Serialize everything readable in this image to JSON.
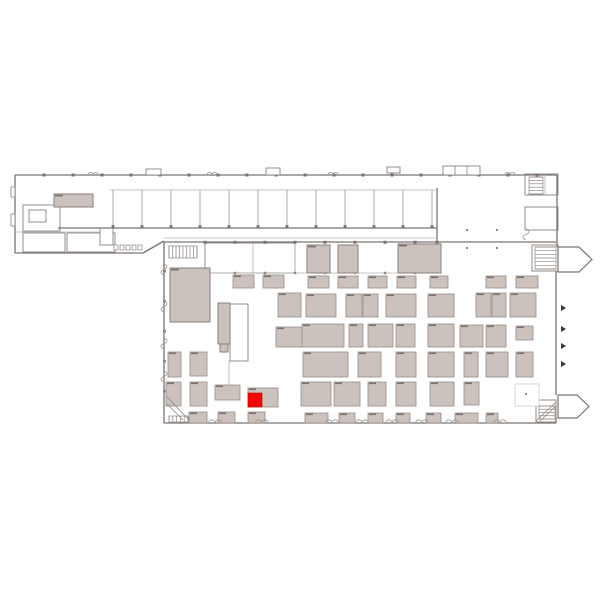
{
  "meta": {
    "view": "exhibition-hall-floor-plan",
    "highlight_count": 1
  },
  "colors": {
    "background": "#ffffff",
    "wall": "#7a7370",
    "light_wall": "#b7b0ac",
    "booth_fill": "#cbc2be",
    "booth_stroke": "#968b86",
    "booth_label": "#7d6f6a",
    "room_stroke": "#8a827e",
    "gray_room_stroke": "#8a7f7a",
    "highlight": "#fb0400",
    "marker": "#3a3633",
    "faint": "#d8d3d0"
  },
  "map": {
    "walls": [
      [
        15,
        175,
        557,
        175
      ],
      [
        15,
        175,
        15,
        253
      ],
      [
        15,
        253,
        143,
        253
      ],
      [
        143,
        253,
        164,
        241
      ],
      [
        58,
        228,
        437,
        228
      ],
      [
        437,
        188,
        437,
        241
      ],
      [
        557,
        175,
        557,
        247
      ],
      [
        556,
        271,
        556,
        395
      ],
      [
        556,
        418,
        556,
        423
      ],
      [
        164,
        242,
        556,
        242
      ],
      [
        164,
        242,
        164,
        423
      ],
      [
        164,
        423,
        556,
        423
      ]
    ],
    "light_walls": [
      [
        110,
        190,
        437,
        190
      ],
      [
        15,
        232,
        100,
        232
      ],
      [
        205,
        273,
        441,
        273
      ],
      [
        253,
        243,
        253,
        273
      ],
      [
        295,
        243,
        295,
        273
      ],
      [
        229,
        361,
        229,
        388
      ],
      [
        164,
        238,
        437,
        238
      ],
      [
        545,
        174,
        545,
        195
      ],
      [
        218,
        323,
        230,
        323
      ],
      [
        218,
        333,
        230,
        333
      ],
      [
        441,
        295,
        441,
        316
      ],
      [
        519,
        293,
        519,
        317
      ],
      [
        406,
        353,
        406,
        376
      ],
      [
        316,
        383,
        316,
        405
      ],
      [
        347,
        383,
        347,
        405
      ],
      [
        406,
        383,
        406,
        405
      ],
      [
        442,
        383,
        442,
        405
      ],
      [
        362,
        325,
        362,
        346
      ]
    ],
    "partitions": {
      "xs": [
        113,
        142,
        171,
        200,
        229,
        258,
        287,
        316,
        345,
        374,
        403,
        432
      ],
      "y1": 190,
      "y2": 227.5
    },
    "top_ticks": {
      "xs": [
        44,
        73,
        102,
        131,
        160,
        189,
        218,
        247,
        276,
        305,
        334,
        363,
        392,
        421,
        450,
        479,
        508,
        537
      ],
      "y": 173.5
    },
    "hall_ticks": {
      "xs": [
        205,
        235,
        265,
        295,
        325,
        355,
        385,
        415,
        437
      ],
      "y": 240.8
    },
    "band_ticks": {
      "xs": [
        235,
        265,
        295,
        325,
        355,
        385,
        415
      ],
      "y": 271.8
    },
    "left_ticks": {
      "ys": [
        270,
        300,
        330,
        360,
        390
      ],
      "x": 163
    },
    "gray_rooms": [
      [
        54,
        194,
        39,
        13
      ],
      [
        170,
        268,
        40,
        54
      ],
      [
        307,
        245,
        23,
        28
      ],
      [
        338,
        245,
        20,
        28
      ],
      [
        398,
        244,
        43,
        29
      ],
      [
        218,
        303,
        12,
        41
      ],
      [
        220,
        344,
        8,
        8
      ]
    ],
    "white_rooms": [
      [
        23,
        205,
        37,
        26
      ],
      [
        23,
        233,
        42,
        19
      ],
      [
        67,
        233,
        48,
        19
      ],
      [
        100,
        228,
        13,
        17
      ],
      [
        525,
        174,
        33,
        21
      ],
      [
        525,
        207,
        33,
        23
      ],
      [
        532,
        245,
        26,
        26
      ],
      [
        230,
        304,
        18,
        57
      ],
      [
        536,
        400,
        20,
        22
      ],
      [
        205,
        243,
        90,
        30
      ]
    ],
    "light_rooms": [
      [
        515,
        384,
        24,
        22
      ]
    ],
    "booths": [
      [
        233,
        275,
        21,
        13
      ],
      [
        263,
        275,
        21,
        13
      ],
      [
        308,
        276,
        21,
        12
      ],
      [
        338,
        276,
        20,
        12
      ],
      [
        368,
        276,
        19,
        12
      ],
      [
        397,
        276,
        19,
        12
      ],
      [
        430,
        276,
        18,
        12
      ],
      [
        486,
        276,
        20,
        12
      ],
      [
        516,
        276,
        22,
        12
      ],
      [
        278,
        293,
        23,
        24
      ],
      [
        306,
        294,
        30,
        23
      ],
      [
        346,
        294,
        16,
        23
      ],
      [
        363,
        294,
        15,
        23
      ],
      [
        386,
        294,
        30,
        23
      ],
      [
        428,
        294,
        26,
        23
      ],
      [
        476,
        293,
        15,
        24
      ],
      [
        492,
        293,
        14,
        24
      ],
      [
        510,
        293,
        26,
        24
      ],
      [
        276,
        327,
        27,
        20
      ],
      [
        302,
        324,
        42,
        23
      ],
      [
        349,
        324,
        14,
        23
      ],
      [
        368,
        324,
        25,
        23
      ],
      [
        396,
        324,
        19,
        23
      ],
      [
        428,
        324,
        26,
        23
      ],
      [
        460,
        325,
        23,
        22
      ],
      [
        486,
        325,
        20,
        22
      ],
      [
        516,
        326,
        17,
        14
      ],
      [
        168,
        352,
        13,
        25
      ],
      [
        190,
        352,
        17,
        24
      ],
      [
        303,
        352,
        45,
        25
      ],
      [
        358,
        352,
        23,
        25
      ],
      [
        396,
        352,
        20,
        25
      ],
      [
        428,
        352,
        26,
        25
      ],
      [
        464,
        352,
        14,
        25
      ],
      [
        486,
        352,
        22,
        25
      ],
      [
        516,
        352,
        17,
        25
      ],
      [
        166,
        382,
        15,
        24
      ],
      [
        190,
        382,
        17,
        24
      ],
      [
        215,
        385,
        25,
        15
      ],
      [
        248,
        388,
        30,
        19
      ],
      [
        301,
        382,
        30,
        24
      ],
      [
        334,
        382,
        26,
        24
      ],
      [
        368,
        382,
        18,
        24
      ],
      [
        396,
        382,
        20,
        24
      ],
      [
        430,
        382,
        24,
        24
      ],
      [
        464,
        382,
        15,
        23
      ],
      [
        189,
        412,
        18,
        11
      ],
      [
        218,
        412,
        17,
        11
      ],
      [
        248,
        412,
        17,
        11
      ],
      [
        305,
        413,
        23,
        10
      ],
      [
        339,
        413,
        16,
        10
      ],
      [
        368,
        413,
        15,
        10
      ],
      [
        396,
        413,
        14,
        10
      ],
      [
        426,
        413,
        15,
        10
      ],
      [
        455,
        413,
        23,
        10
      ],
      [
        486,
        413,
        12,
        10
      ]
    ],
    "highlight_booth": [
      248,
      393,
      14,
      14
    ],
    "stairs": [
      {
        "x": 169,
        "y": 246,
        "w": 28,
        "h": 12,
        "n": 9,
        "dir": "v"
      },
      {
        "x": 529,
        "y": 177,
        "w": 14,
        "h": 17,
        "n": 6,
        "dir": "h"
      },
      {
        "x": 535,
        "y": 247,
        "w": 21,
        "h": 22,
        "n": 7,
        "dir": "h"
      },
      {
        "x": 559,
        "y": 400,
        "w": 13,
        "h": 17,
        "n": 6,
        "dir": "h"
      },
      {
        "x": 539,
        "y": 406,
        "w": 16,
        "h": 13,
        "n": 5,
        "dir": "h"
      },
      {
        "x": 169,
        "y": 416,
        "w": 19,
        "h": 6,
        "n": 6,
        "dir": "v"
      },
      {
        "x": 30,
        "y": 212,
        "w": 15,
        "h": 8,
        "n": 3,
        "dir": "h"
      }
    ],
    "arrows": [
      "558,247 579,247 592,259.5 579,272 558,272",
      "558,395 577,395 589,406.5 577,418 558,418"
    ],
    "markers": [
      [
        561,
        305
      ],
      [
        561,
        326
      ],
      [
        561,
        343
      ],
      [
        561,
        361
      ]
    ],
    "top_boxes": [
      [
        146,
        169,
        15,
        6
      ],
      [
        266,
        168,
        14,
        7
      ],
      [
        387,
        167,
        13,
        6
      ],
      [
        443,
        166,
        37,
        9
      ]
    ],
    "box_dividers": [
      [
        455,
        166,
        455,
        175
      ],
      [
        467,
        166,
        467,
        175
      ]
    ],
    "diagonals": [
      [
        167,
        397,
        189,
        420
      ],
      [
        167,
        404,
        183,
        420
      ],
      [
        536,
        421,
        556,
        402
      ],
      [
        540,
        421,
        556,
        406
      ]
    ],
    "notches_bottom": [
      215,
      262,
      332,
      362,
      392,
      422,
      452,
      500
    ],
    "notches_top": [
      93,
      212,
      333,
      510
    ],
    "springs": [
      [
        164,
        264
      ],
      [
        164,
        301
      ],
      [
        164,
        338
      ],
      [
        164,
        371
      ],
      [
        526,
        229
      ]
    ],
    "dots": [
      [
        466,
        229
      ],
      [
        496,
        229
      ],
      [
        466,
        247
      ],
      [
        496,
        247
      ],
      [
        525,
        393
      ]
    ],
    "fixtures": [
      [
        114,
        245,
        4,
        5
      ],
      [
        120,
        245,
        4,
        5
      ],
      [
        126,
        245,
        4,
        5
      ],
      [
        132,
        245,
        4,
        5
      ],
      [
        138,
        245,
        4,
        5
      ]
    ],
    "desk": [
      29,
      210,
      17,
      12
    ],
    "wall_bumps": [
      [
        11,
        187,
        4,
        10
      ],
      [
        11,
        214,
        4,
        12
      ]
    ]
  }
}
